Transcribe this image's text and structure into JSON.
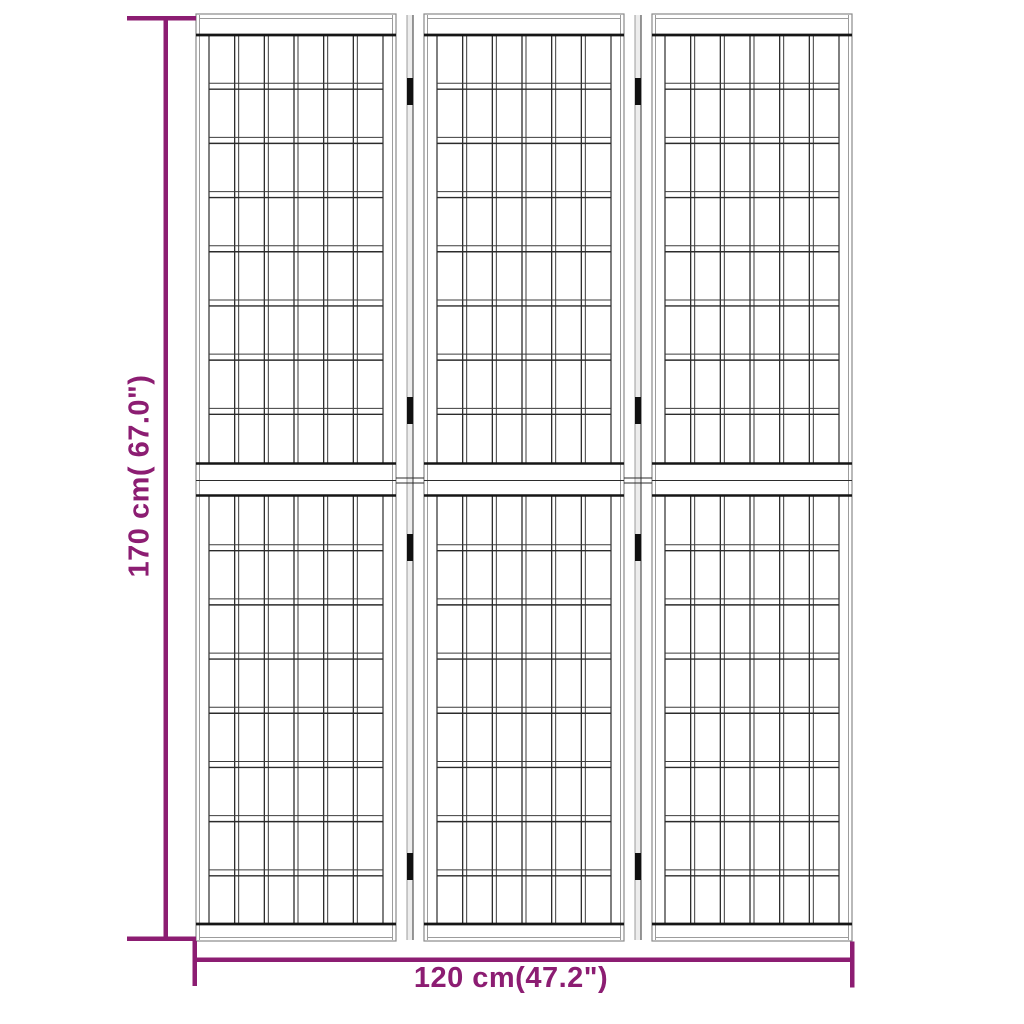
{
  "page": {
    "background": "#ffffff"
  },
  "dimension_annotations": {
    "accent_color": "#8C1D72",
    "height": {
      "label": "170 cm( 67.0\")"
    },
    "width": {
      "label": "120 cm(47.2\")"
    }
  },
  "diagram": {
    "subject": "3-panel folding room divider (Japanese shoji style), front line drawing",
    "colors": {
      "line": "#2b2b2b",
      "line_light": "#3d3d3d",
      "thick": "#151515",
      "frame": "#8a8a8a",
      "frame_inner": "#9c9c9c",
      "hinge": "#101010",
      "hinge_strip_fill": "#ededed",
      "hinge_strip_edge_l": "#9c9c9c",
      "hinge_strip_edge_r": "#555555",
      "fill": "#ffffff"
    },
    "screen": {
      "x": 196,
      "y": 14,
      "width": 656,
      "height": 927
    },
    "panels": {
      "count": 3,
      "panel_width": 200,
      "gap_width": 28
    },
    "grid": {
      "columns": 6,
      "rows_upper": 8,
      "rows_lower": 8,
      "stile_width": 13,
      "slat_width": 4,
      "rail_height": 6
    },
    "bands": {
      "top_inner_y": 18.5,
      "top_thick_y": 35,
      "mid_top_y": 463.5,
      "mid_center_y": 480.5,
      "mid_bottom_y": 495.5,
      "bottom_thick_y": 924,
      "bottom_inner_y": 937.5
    },
    "hinges": {
      "per_gap": 4,
      "tops": [
        78,
        397,
        534,
        853
      ],
      "height": 27,
      "width": 6
    },
    "gap_cross_lines_y": [
      478,
      483
    ],
    "dimension_lines": {
      "vertical": {
        "x": 163.5,
        "y1": 16,
        "y2": 941,
        "thickness": 4.5,
        "cap_x1": 127,
        "cap_x2": 196
      },
      "horizontal": {
        "y": 957.5,
        "x1": 195,
        "x2": 852,
        "thickness": 4.5,
        "cap_y1": 941,
        "cap_y2": 987
      }
    }
  }
}
